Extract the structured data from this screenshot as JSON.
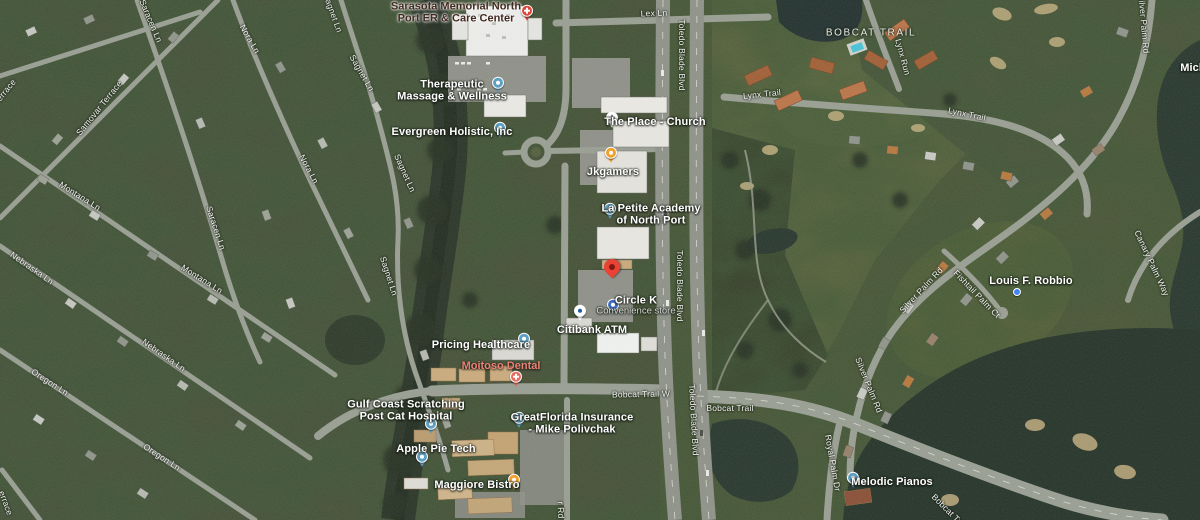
{
  "map": {
    "view": "satellite",
    "marker": {
      "id": "dropped-pin",
      "x": 612,
      "y": 281,
      "color": "#EA4335"
    },
    "locality": {
      "id": "bobcat-trail-community",
      "text": "BOBCAT TRAIL",
      "x": 871,
      "y": 33
    },
    "colors": {
      "poi_text": "#ffffff",
      "sub_text": "#d4d7d0",
      "road_text": "#f3f4ef",
      "hospital_text": "#41291f",
      "health_text": "#ed8076",
      "locality_text": "#eaece5",
      "pin_generic": "#5FA0C2",
      "pin_food": "#F0A12D",
      "pin_circle_k": "#3E6FC4",
      "pin_citibank_bg": "#ffffff",
      "pin_citibank_glyph": "#1E5BA8",
      "pin_health": "#E8695E",
      "pin_hospital": "#DB4437",
      "pin_church_bg": "#ffffff",
      "pin_church_glyph": "#8a8f98",
      "pin_dot": "#4285F4"
    },
    "pois": [
      {
        "id": "sarasota-memorial-er",
        "lines": [
          "Sarasota Memorial North",
          "Port ER & Care Center"
        ],
        "x": 456,
        "y": 13,
        "style": "hospital",
        "pin": {
          "type": "hospital",
          "x": 527,
          "y": 14
        }
      },
      {
        "id": "therapeutic-massage-wellness",
        "lines": [
          "Therapeutic",
          "Massage & Wellness"
        ],
        "x": 452,
        "y": 91,
        "style": "poi",
        "pin": {
          "type": "generic",
          "x": 498,
          "y": 86
        }
      },
      {
        "id": "evergreen-holistic",
        "lines": [
          "Evergreen Holistic, Inc"
        ],
        "x": 452,
        "y": 132,
        "style": "poi",
        "pin": {
          "type": "generic",
          "x": 500,
          "y": 131
        }
      },
      {
        "id": "the-place-church",
        "lines": [
          "The Place - Church"
        ],
        "x": 655,
        "y": 122,
        "style": "poi",
        "pin": {
          "type": "church",
          "x": 612,
          "y": 121
        }
      },
      {
        "id": "jkgamers",
        "lines": [
          "Jkgamers"
        ],
        "x": 613,
        "y": 172,
        "style": "poi",
        "pin": {
          "type": "food",
          "x": 611,
          "y": 156
        }
      },
      {
        "id": "la-petite-academy",
        "lines": [
          "La Petite Academy",
          "of North Port"
        ],
        "x": 651,
        "y": 215,
        "style": "poi",
        "pin": {
          "type": "generic",
          "x": 610,
          "y": 212
        }
      },
      {
        "id": "circle-k",
        "lines": [
          "Circle K"
        ],
        "sub": "Convenience store",
        "x": 636,
        "y": 306,
        "style": "poi",
        "pin": {
          "type": "circle-k",
          "x": 613,
          "y": 308
        }
      },
      {
        "id": "citibank-atm",
        "lines": [
          "Citibank ATM"
        ],
        "x": 592,
        "y": 330,
        "style": "poi",
        "pin": {
          "type": "citibank",
          "x": 580,
          "y": 314
        }
      },
      {
        "id": "pricing-healthcare",
        "lines": [
          "Pricing Healthcare"
        ],
        "x": 481,
        "y": 345,
        "style": "poi",
        "pin": {
          "type": "generic",
          "x": 524,
          "y": 342
        }
      },
      {
        "id": "moitoso-dental",
        "lines": [
          "Moitoso Dental"
        ],
        "x": 501,
        "y": 366,
        "style": "health",
        "pin": {
          "type": "health",
          "x": 516,
          "y": 380
        }
      },
      {
        "id": "gulf-coast-cat-hospital",
        "lines": [
          "Gulf Coast Scratching",
          "Post Cat Hospital"
        ],
        "x": 406,
        "y": 411,
        "style": "poi",
        "pin": {
          "type": "generic",
          "x": 431,
          "y": 427
        }
      },
      {
        "id": "greatflorida-insurance",
        "lines": [
          "GreatFlorida Insurance",
          "- Mike Polivchak"
        ],
        "x": 572,
        "y": 424,
        "style": "poi",
        "pin": {
          "type": "generic",
          "x": 519,
          "y": 421
        }
      },
      {
        "id": "apple-pie-tech",
        "lines": [
          "Apple Pie Tech"
        ],
        "x": 436,
        "y": 449,
        "style": "poi",
        "pin": {
          "type": "generic",
          "x": 422,
          "y": 460
        }
      },
      {
        "id": "maggiore-bistro",
        "lines": [
          "Maggiore Bistro"
        ],
        "x": 477,
        "y": 485,
        "style": "poi",
        "pin": {
          "type": "food",
          "x": 514,
          "y": 483
        }
      },
      {
        "id": "melodic-pianos",
        "lines": [
          "Melodic Pianos"
        ],
        "x": 892,
        "y": 482,
        "style": "poi",
        "pin": {
          "type": "generic",
          "x": 853,
          "y": 481
        }
      },
      {
        "id": "louis-f-robbio",
        "lines": [
          "Louis F. Robbio"
        ],
        "x": 1031,
        "y": 281,
        "style": "poi",
        "pin": {
          "type": "dot",
          "x": 1017,
          "y": 292
        }
      },
      {
        "id": "mich-partial",
        "lines": [
          "Mich"
        ],
        "x": 1193,
        "y": 68,
        "style": "poi",
        "pin": null
      }
    ],
    "roads": [
      {
        "text": "Lex Ln",
        "x": 654,
        "y": 13,
        "rot": -2
      },
      {
        "text": "Toledo Blade Blvd",
        "x": 682,
        "y": 55,
        "rot": 90
      },
      {
        "text": "Toledo Blade Blvd",
        "x": 680,
        "y": 286,
        "rot": 90
      },
      {
        "text": "Toledo Blade Blvd",
        "x": 694,
        "y": 420,
        "rot": 87
      },
      {
        "text": "Bobcat Trail W",
        "x": 641,
        "y": 394,
        "rot": -1
      },
      {
        "text": "Bobcat Trail",
        "x": 730,
        "y": 408,
        "rot": 0
      },
      {
        "text": "Lynx Trail",
        "x": 762,
        "y": 94,
        "rot": -6
      },
      {
        "text": "Lynx Run",
        "x": 903,
        "y": 57,
        "rot": 75
      },
      {
        "text": "Lynx Trail",
        "x": 967,
        "y": 114,
        "rot": 12
      },
      {
        "text": "Silver Palm Rd",
        "x": 1144,
        "y": 24,
        "rot": 85
      },
      {
        "text": "Silver Palm Rd",
        "x": 921,
        "y": 290,
        "rot": -47
      },
      {
        "text": "Silver Palm Rd",
        "x": 869,
        "y": 385,
        "rot": 68
      },
      {
        "text": "Fishtail Palm Ct",
        "x": 977,
        "y": 294,
        "rot": 46
      },
      {
        "text": "Canary Palm Way",
        "x": 1152,
        "y": 263,
        "rot": 65
      },
      {
        "text": "Royal Palm Dr",
        "x": 833,
        "y": 463,
        "rot": 80
      },
      {
        "text": "Saracen Ln",
        "x": 151,
        "y": 21,
        "rot": 67
      },
      {
        "text": "Saracen Ln",
        "x": 216,
        "y": 228,
        "rot": 72
      },
      {
        "text": "Samovar Terrace",
        "x": 99,
        "y": 108,
        "rot": -51
      },
      {
        "text": "errace",
        "x": 6,
        "y": 90,
        "rot": -51
      },
      {
        "text": "Montana Ln",
        "x": 80,
        "y": 196,
        "rot": 32
      },
      {
        "text": "Montana Ln",
        "x": 202,
        "y": 279,
        "rot": 32
      },
      {
        "text": "Nora Ln",
        "x": 250,
        "y": 39,
        "rot": 60
      },
      {
        "text": "Nora Ln",
        "x": 309,
        "y": 169,
        "rot": 62
      },
      {
        "text": "Sagnet Ln",
        "x": 333,
        "y": 13,
        "rot": 70
      },
      {
        "text": "Sagnet Ln",
        "x": 362,
        "y": 73,
        "rot": 60
      },
      {
        "text": "Sagnet Ln",
        "x": 405,
        "y": 173,
        "rot": 66
      },
      {
        "text": "Sagnet Ln",
        "x": 389,
        "y": 276,
        "rot": 72
      },
      {
        "text": "Nebraska Ln",
        "x": 32,
        "y": 268,
        "rot": 35
      },
      {
        "text": "Nebraska Ln",
        "x": 164,
        "y": 355,
        "rot": 35
      },
      {
        "text": "Oregon Ln",
        "x": 50,
        "y": 382,
        "rot": 33
      },
      {
        "text": "Oregon Ln",
        "x": 162,
        "y": 457,
        "rot": 33
      },
      {
        "text": "errace",
        "x": 6,
        "y": 503,
        "rot": 70
      },
      {
        "text": "r Rd",
        "x": 561,
        "y": 510,
        "rot": 88
      },
      {
        "text": "Bobcat Trail",
        "x": 950,
        "y": 512,
        "rot": 45
      }
    ]
  }
}
